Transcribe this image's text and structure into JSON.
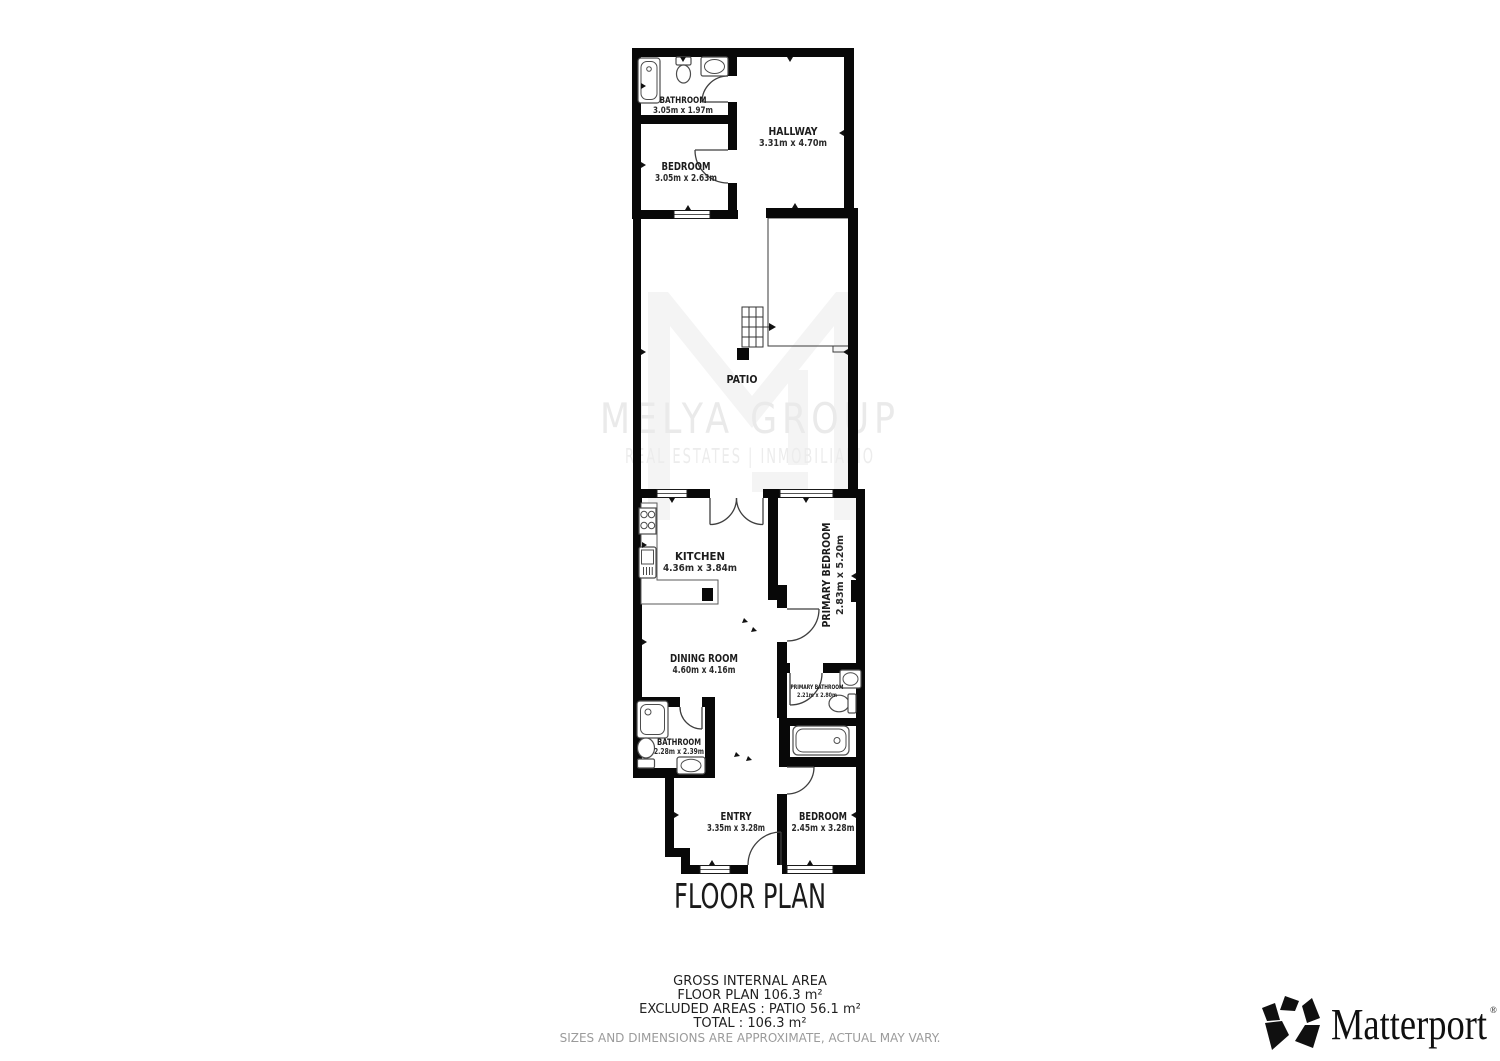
{
  "watermark": {
    "brand": "MELYA GROUP",
    "tagline": "REAL ESTATES | INMOBILIARIO"
  },
  "rooms": {
    "bathroom_top": {
      "name": "BATHROOM",
      "dims": "3.05m x 1.97m"
    },
    "bedroom_top": {
      "name": "BEDROOM",
      "dims": "3.05m x 2.63m"
    },
    "hallway": {
      "name": "HALLWAY",
      "dims": "3.31m x 4.70m"
    },
    "patio": {
      "name": "PATIO"
    },
    "kitchen": {
      "name": "KITCHEN",
      "dims": "4.36m x 3.84m"
    },
    "primary_bedroom": {
      "name": "PRIMARY BEDROOM",
      "dims": "2.83m x 5.20m"
    },
    "dining_room": {
      "name": "DINING ROOM",
      "dims": "4.60m x 4.16m"
    },
    "primary_bathroom": {
      "name": "PRIMARY BATHROOM",
      "dims": "2.21m x 2.80m"
    },
    "bathroom_lower": {
      "name": "BATHROOM",
      "dims": "2.28m x 2.39m"
    },
    "entry": {
      "name": "ENTRY",
      "dims": "3.35m x 3.28m"
    },
    "bedroom_lower": {
      "name": "BEDROOM",
      "dims": "2.45m x 3.28m"
    }
  },
  "title": "FLOOR PLAN",
  "summary": {
    "gross_internal_area": "GROSS INTERNAL AREA",
    "floor_plan_area": "FLOOR PLAN 106.3 m²",
    "excluded_areas": "EXCLUDED AREAS :  PATIO 56.1 m²",
    "total": "TOTAL :  106.3 m²",
    "disclaimer": "SIZES AND DIMENSIONS ARE APPROXIMATE, ACTUAL MAY VARY."
  },
  "branding": {
    "logo_text": "Matterport",
    "registered_mark": "®"
  },
  "colors": {
    "wall": "#080808",
    "fixture_line": "#4d4d4d",
    "watermark_text": "#eaeaea",
    "watermark_mark": "#f4f4f4",
    "disclaimer": "#9b9b9b",
    "logo": "#101010"
  }
}
